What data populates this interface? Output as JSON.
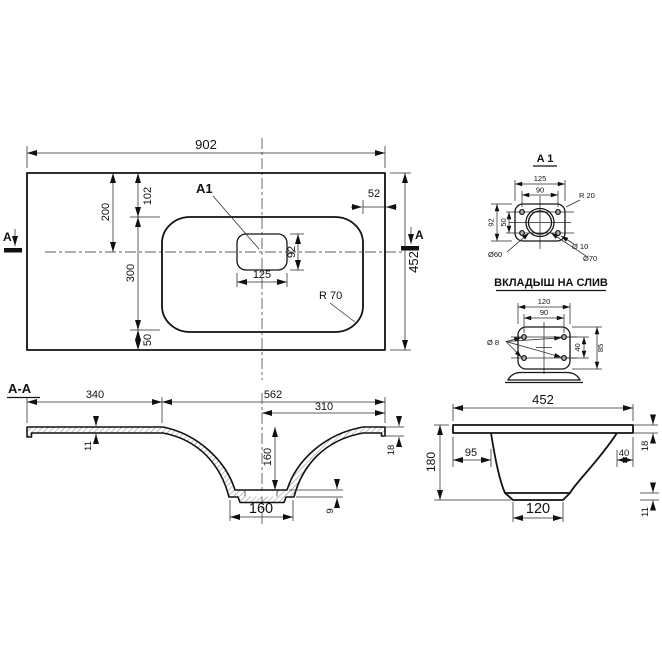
{
  "colors": {
    "line": "#111111",
    "background": "#ffffff"
  },
  "top_view": {
    "dim_width": "902",
    "dim_height": "452",
    "dim_top_to_center": "200",
    "dim_top_to_basin": "102",
    "dim_basin_height": "300",
    "dim_basin_to_bottom": "50",
    "dim_right_edge": "52",
    "hole_width": "125",
    "hole_height": "92",
    "radius_label": "R 70",
    "detail_ref": "A1",
    "section_letter_left": "A",
    "section_letter_right": "A"
  },
  "detail_a1": {
    "title": "A 1",
    "dim_width": "125",
    "dim_hole_spacing_h": "90",
    "dim_height": "92",
    "dim_hole_spacing_v": "50",
    "radius_label": "R 20",
    "dia_center": "Ø60",
    "dia_holes": "Ø 10",
    "dia_outer": "Ø70"
  },
  "drain_insert": {
    "title": "ВКЛАДЫШ НА СЛИВ",
    "dim_width": "120",
    "dim_hole_spacing_h": "90",
    "dim_hole_spacing_v": "40",
    "dim_height": "85",
    "dia_holes": "Ø 8"
  },
  "section_aa": {
    "title": "A-A",
    "dim_left_flat": "340",
    "dim_bowl_span": "562",
    "dim_half_span": "310",
    "dim_thickness": "11",
    "dim_depth": "160",
    "dim_bottom_width": "160",
    "dim_edge_thickness": "18",
    "dim_bottom_thickness": "9"
  },
  "side_view": {
    "dim_width": "452",
    "dim_height": "180",
    "dim_left_offset": "95",
    "dim_right_offset": "40",
    "dim_thickness": "18",
    "dim_bottom_width": "120",
    "dim_lip": "11"
  }
}
